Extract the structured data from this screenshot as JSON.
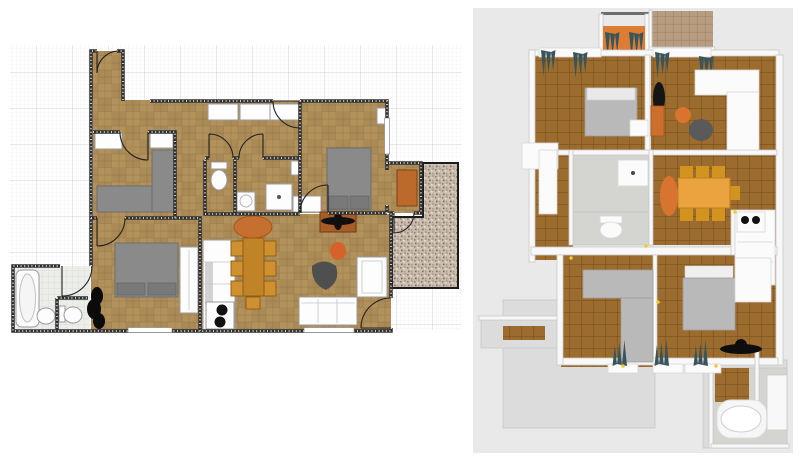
{
  "app": {
    "description": "floor-plan editor export: 2D plan view beside 3D aerial render",
    "visible_text": "none"
  },
  "colors": {
    "wood2d": "#b3915a",
    "wall2d": "#2f2f2f",
    "chair2d": "#cf9030",
    "table2d": "#c08328",
    "rug-orange": "#c76f2f",
    "fan-rug": "#a85c28",
    "orange": "#d8742f",
    "entry-floor-3d": "#dd7d33",
    "wood3d": "#9c6c2e",
    "tile3d": "#b79c80",
    "gravel-base": "#c9bcae",
    "curtain": "#3a545b",
    "bed-gray-2d": "#8f8f8f",
    "bed-gray-3d": "#bdbdbd",
    "panel3d-bg": "#e9e9e9",
    "grid-minor": "#ebebeb",
    "grid-major": "#d2d2d2"
  },
  "plan2d": {
    "name": "2D floor plan canvas",
    "grid": {
      "minor_px": 4,
      "major_px": 36
    },
    "rooms": [
      "entry",
      "hall",
      "bedroom-upper-left",
      "corridor",
      "dressing-hall",
      "bedroom-right",
      "terrace-nook",
      "wc",
      "bathroom-shower",
      "living-dining-kitchen",
      "bedroom-lower-left",
      "bathroom-bathtub",
      "gravel-terrace"
    ],
    "furniture": [
      "entry-door",
      "wardrobe-closets",
      "corner-sofa-gray",
      "double-bed-right",
      "double-bed-lower-left",
      "wardrobe-strip",
      "toilet",
      "washing-machine",
      "shower",
      "bathtub",
      "bidet",
      "toilet-2",
      "plant",
      "kitchen-counter",
      "stove-two-burners",
      "dining-table",
      "dining-chairs-x7",
      "orange-round-rug",
      "ceiling-fan-on-rug",
      "orange-armchair",
      "dark-bean-chair",
      "white-sofa",
      "white-armchair",
      "orange-cabinet-nook"
    ]
  },
  "view3d": {
    "name": "3D aerial render canvas",
    "rooms": [
      "entry-porch",
      "roof-terrace-tiled",
      "bedroom-top-left",
      "living-room",
      "hallway-left",
      "bathroom-shower",
      "wc",
      "dining-area",
      "kitchen",
      "hall-lower-left",
      "bedroom-lower-right",
      "bathroom-bathtub",
      "balcony-slab"
    ],
    "furniture": [
      "teal-curtains-x9",
      "double-bed-top",
      "double-bed-bottom",
      "white-l-sofa",
      "orange-pouf",
      "dark-bean-chair",
      "ceiling-fan-black-x2",
      "orange-cabinet",
      "gray-l-wardrobe",
      "white-wardrobes",
      "dining-table-chairs",
      "stove-two-burners",
      "toilet",
      "shower",
      "bathtub",
      "orange-runner-rug",
      "ceiling-lights-yellow"
    ]
  }
}
